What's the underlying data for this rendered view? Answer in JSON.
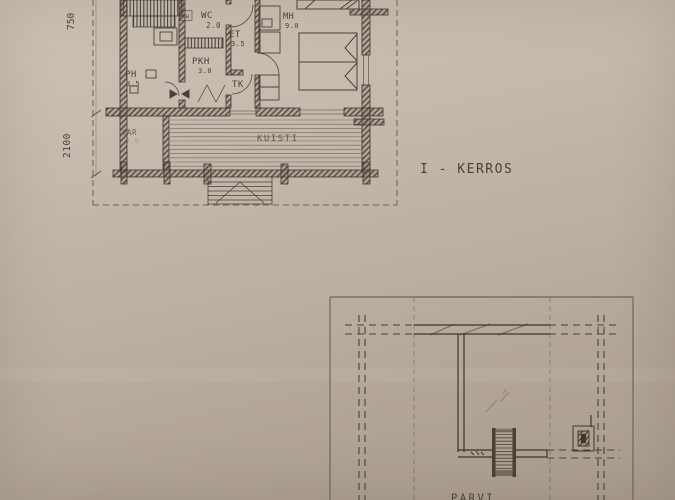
{
  "palette": {
    "ink": "#4a4138",
    "wall": "#3e362c",
    "paper_light": "#ccc2b5",
    "paper_dark": "#a99c8d"
  },
  "floor_plan_1": {
    "caption": "I - KERROS",
    "rooms": [
      {
        "label": "PH",
        "area": "3.5"
      },
      {
        "label": "PKH",
        "area": "3.0"
      },
      {
        "label": "WC",
        "area": "2.0"
      },
      {
        "label": "KH",
        "area": ""
      },
      {
        "label": "ET",
        "area": "3.5"
      },
      {
        "label": "TK",
        "area": ""
      },
      {
        "label": "MH",
        "area": "9.0"
      },
      {
        "label": "VAR",
        "area": "2.0"
      },
      {
        "label": "KUISTI",
        "area": ""
      }
    ],
    "dimensions": [
      "750",
      "2100"
    ]
  },
  "floor_plan_2": {
    "caption": "PARVI"
  }
}
